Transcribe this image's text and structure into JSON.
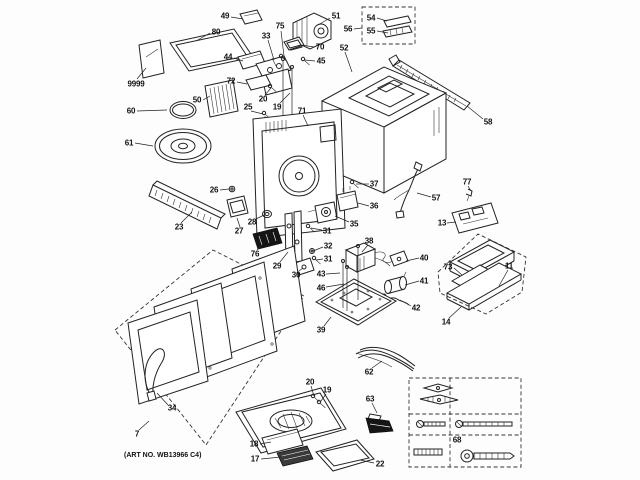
{
  "page": {
    "background": "#fdfdfd",
    "ink": "#1a1a1a",
    "kind": "exploded-parts-diagram",
    "product": "over-the-range microwave"
  },
  "artwork": {
    "art_no": "(ART NO. WB13966 C4)"
  },
  "callouts": [
    {
      "text": "49"
    },
    {
      "text": "80"
    },
    {
      "text": "9999"
    },
    {
      "text": "33"
    },
    {
      "text": "75"
    },
    {
      "text": "51"
    },
    {
      "text": "70"
    },
    {
      "text": "56"
    },
    {
      "text": "54"
    },
    {
      "text": "55"
    },
    {
      "text": "52"
    },
    {
      "text": "45"
    },
    {
      "text": "44"
    },
    {
      "text": "72"
    },
    {
      "text": "20"
    },
    {
      "text": "19"
    },
    {
      "text": "25"
    },
    {
      "text": "71"
    },
    {
      "text": "50"
    },
    {
      "text": "60"
    },
    {
      "text": "61"
    },
    {
      "text": "58"
    },
    {
      "text": "23"
    },
    {
      "text": "26"
    },
    {
      "text": "28"
    },
    {
      "text": "27"
    },
    {
      "text": "76"
    },
    {
      "text": "37"
    },
    {
      "text": "36"
    },
    {
      "text": "35"
    },
    {
      "text": "57"
    },
    {
      "text": "77"
    },
    {
      "text": "13"
    },
    {
      "text": "73"
    },
    {
      "text": "11"
    },
    {
      "text": "14"
    },
    {
      "text": "38"
    },
    {
      "text": "40"
    },
    {
      "text": "41"
    },
    {
      "text": "42"
    },
    {
      "text": "31"
    },
    {
      "text": "32"
    },
    {
      "text": "31"
    },
    {
      "text": "30"
    },
    {
      "text": "29"
    },
    {
      "text": "43"
    },
    {
      "text": "46"
    },
    {
      "text": "39"
    },
    {
      "text": "62"
    },
    {
      "text": "63"
    },
    {
      "text": "18"
    },
    {
      "text": "17"
    },
    {
      "text": "22"
    },
    {
      "text": "20"
    },
    {
      "text": "19"
    },
    {
      "text": "34"
    },
    {
      "text": "7"
    },
    {
      "text": "68"
    }
  ]
}
